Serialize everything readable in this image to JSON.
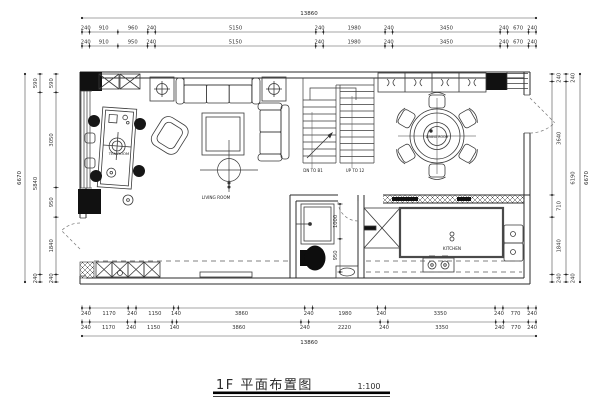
{
  "sheet": {
    "title": "1F 平面布置图",
    "scale": "1:100"
  },
  "rooms": {
    "living": "LIVING ROOM",
    "tea": "TEA ROOM",
    "dining": "DINING ROOM",
    "kitchen": "KITCHEN"
  },
  "stairs": {
    "down": "DN TO B1",
    "up": "UP TO 12"
  },
  "dimensions": {
    "top": {
      "total": "13860",
      "rows": [
        [
          "240",
          "910",
          "960",
          "240",
          "5150",
          "240",
          "1980",
          "240",
          "3450",
          "240",
          "670",
          "240"
        ],
        [
          "240",
          "910",
          "950",
          "240",
          "5150",
          "240",
          "1980",
          "240",
          "3450",
          "240",
          "670",
          "240"
        ]
      ]
    },
    "bottom": {
      "total": "13860",
      "rows": [
        [
          "240",
          "1170",
          "240",
          "1150",
          "140",
          "3860",
          "240",
          "1980",
          "240",
          "3350",
          "240",
          "770",
          "240"
        ],
        [
          "240",
          "1170",
          "240",
          "1150",
          "140",
          "3860",
          "240",
          "2220",
          "240",
          "3350",
          "240",
          "770",
          "240"
        ]
      ]
    },
    "left": {
      "total": "6670",
      "rows": [
        [
          "590",
          "5840",
          "240"
        ],
        [
          "590",
          "3050",
          "950",
          "1840",
          "240"
        ]
      ]
    },
    "right": {
      "total": "6670",
      "rows": [
        [
          "240",
          "3640",
          "710",
          "1840",
          "240"
        ],
        [
          "240",
          "6190",
          "240"
        ]
      ]
    },
    "bathroom": {
      "rows": [
        [
          "1000",
          "950"
        ]
      ]
    }
  },
  "colors": {
    "ink": "#2b2b2b",
    "dim": "#4a4a4a",
    "solid_fill": "#111111",
    "paper": "#ffffff"
  }
}
